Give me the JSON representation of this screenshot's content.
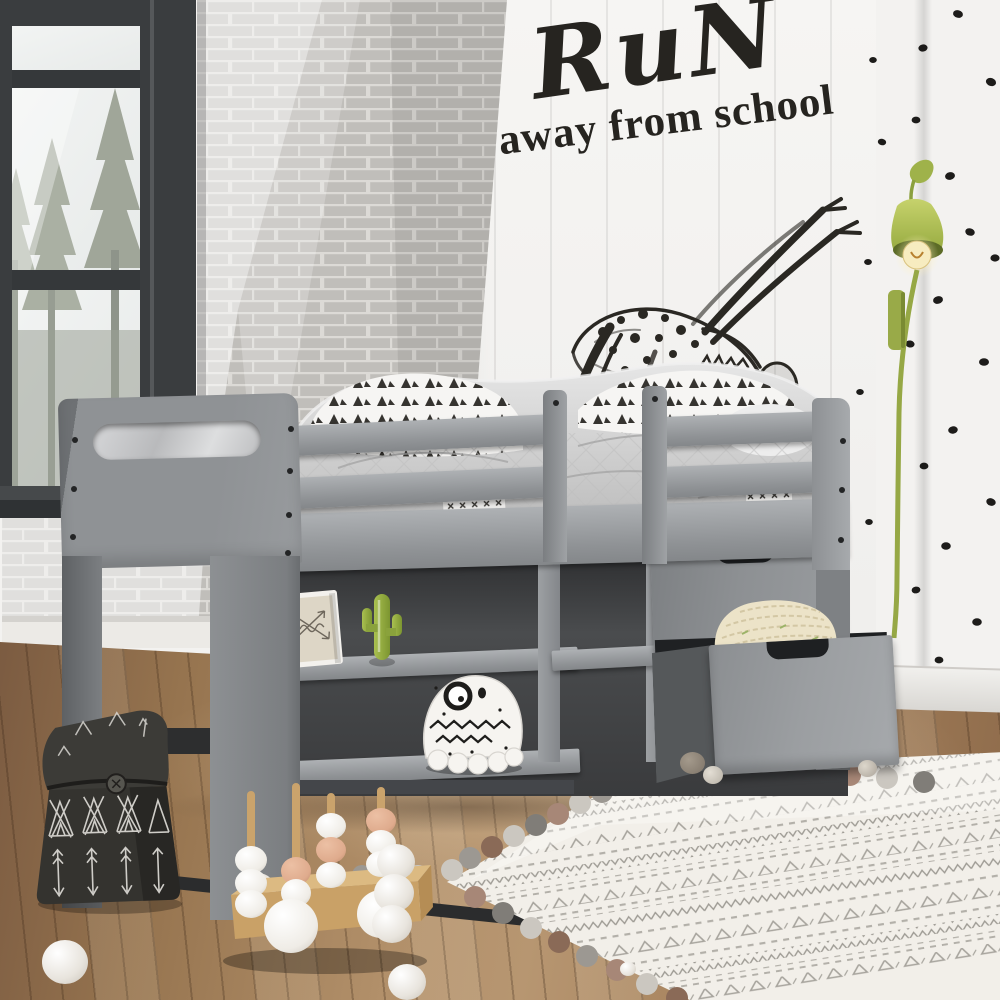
{
  "meta": {
    "type": "interior-photo",
    "room": "kids bedroom with grey twin loft bed"
  },
  "wall_quote": {
    "line1": "RuN",
    "line2": "away from school",
    "color": "#262420"
  },
  "palette": {
    "bed_grey": "#8e9194",
    "bed_grey_light": "#a8abae",
    "bed_grey_dark": "#6f7275",
    "wall_white": "#f3f2f0",
    "brick_grey": "#bfbdba",
    "floor_wood": "#a07e5d",
    "lamp_green": "#a6b54d",
    "rug_cream": "#f1eee8",
    "pompom_rust": "#96705d",
    "bag_black": "#33322f",
    "cactus_green": "#8fae3c",
    "pillow_cream": "#eae1c6",
    "toy_wood": "#cda76f",
    "toy_blush": "#dfab8d",
    "ink_black": "#26241f"
  },
  "objects": {
    "window": "black-framed window with pine forest view",
    "brick_wall": "white painted brick wall",
    "panel_wall": "white shiplap wall",
    "dots_wall": "white wall with black polka dots",
    "sketch": "charcoal insect drawing on wall",
    "lamp": "green tulip wall sconce with filament bulb",
    "bed": "grey twin loft bed with guard rails",
    "bookshelf": "under-bed bookshelf",
    "frame": "leaning doodle picture frame",
    "cactus": "green ceramic cactus figurine",
    "plush": "white monster plush toy",
    "drawers": "under-bed storage drawers",
    "open_drawer": "open drawer with cream knit pillow",
    "bag": "black canvas bag with teepee and arrow print",
    "toy": "wooden stacking-ball wagon toy",
    "rug": "cream boho rug with pompom trim",
    "floor": "oak plank floor"
  }
}
